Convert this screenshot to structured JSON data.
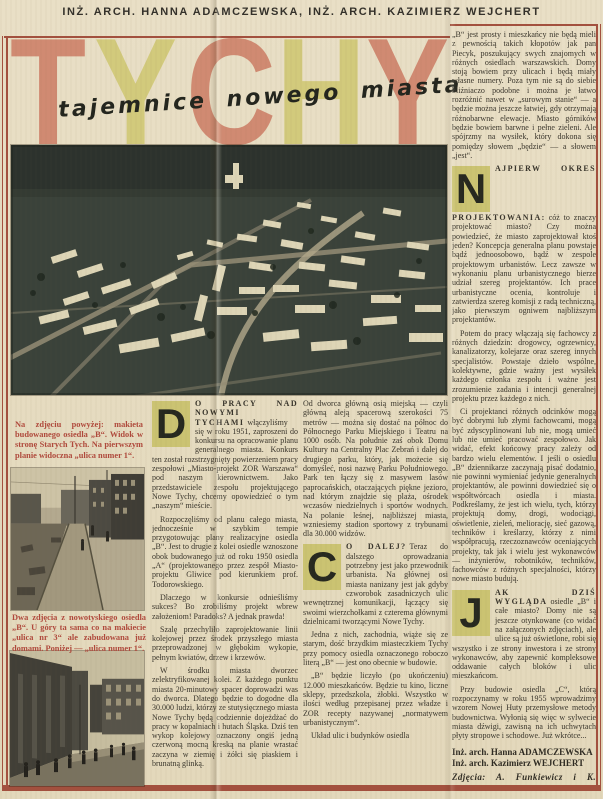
{
  "header": "INŻ. ARCH. HANNA ADAMCZEWSKA, INŻ. ARCH. KAZIMIERZ WEJCHERT",
  "title": {
    "letters": [
      "T",
      "Y",
      "C",
      "H",
      "Y"
    ],
    "subtitle": "tajemnice nowego miasta"
  },
  "colors": {
    "paper": "#e7ddc2",
    "frame_red": "#a3503e",
    "caption_red": "#b0493c",
    "title_salmon": "#d08a72",
    "title_olive": "#d2ca7c",
    "dropcap_bg": "#cbc372",
    "ink": "#37332a",
    "photo_dark": "#3a423a"
  },
  "captions": {
    "model": "Na zdjęciu powyżej: makieta budowanego osiedla „B“. Widok w stronę Starych Tych. Na pierwszym planie widoczna „ulica numer 1“.",
    "streets": "Dwa zdjęcia z nowotyskiego osiedla „B“. U góry ta sama co na makiecie „ulica nr 3“ ale zabudowana już domami. Poniżej — „ulica numer 1“."
  },
  "col1": {
    "drop1": "D",
    "lead1": "O PRACY NAD NOWYMI TYCHAMI",
    "p1": "włączyliśmy się w roku 1951, zaproszeni do konkursu na opracowanie planu generalnego miasta. Konkurs ten został rozstrzygnięty powierzeniem pracy zespołowi „Miasto-projekt ZOR Warszawa“ pod naszym kierownictwem. Jako przedstawiciele zespołu projektującego Nowe Tychy, chcemy opowiedzieć o tym „naszym“ mieście.",
    "p2": "Rozpoczęliśmy od planu całego miasta, jednocześnie w szybkim tempie przygotowując plany realizacyjne osiedla „B“. Jest to drugie z kolei osiedle wznoszone obok budowanego już od roku 1950 osiedla „A“ (projektowanego przez zespół Miasto-projektu Gliwice pod kierunkiem prof. Todorowskiego.",
    "p3": "Dlaczego w konkursie odnieśliśmy sukces? Bo zrobiliśmy projekt wbrew założeniom! Paradoks? A jednak prawda!",
    "p4": "Szalę przechyliło zaprojektowanie linii kolejowej przez środek przyszłego miasta przeprowadzonej w głębokim wykopie, pełnym kwiatów, drzew i krzewów.",
    "p5": "W środku miasta dworzec zelektryfikowanej kolei. Z każdego punktu miasta 20-minutowy spacer doprowadzi was do dworca. Dlatego będzie to dogodne dla 30.000 ludzi, którzy ze stutysięcznego miasta Nowe Tychy będą codziennie dojeżdżać do pracy w kopalniach i hutach Śląska. Dziś ten wykop kolejowy oznaczony ongiś jedną czerwoną mocną kreską na planie wrastać zaczyna w ziemię i żółci się piaskiem i brunatną glinką."
  },
  "col2": {
    "p1": "Od dworca główną osią miejską — czyli główną aleją spacerową szerokości 75 metrów — można się dostać na północ do Północnego Parku Miejskiego i Teatru na 1000 osób. Na południe zaś obok Domu Kultury na Centralny Plac Zebrań i dalej do drugiego parku, który, jak możecie się domyśleć, nosi nazwę Parku Południowego. Park ten łączy się z masywem lasów paprocańskich, otaczających piękne jezioro, nad którym znajdzie się plaża, ośrodek wczasów niedzielnych i sportów wodnych. Na polanie leśnej, najbliższej miasta, wzniesiemy stadion sportowy z trybunami dla 30.000 widzów.",
    "drop2": "C",
    "lead2": "O DALEJ?",
    "p2": "Teraz do dalszego oprowadzania potrzebny jest jako przewodnik urbanista. Na głównej osi miasta nanizany jest jak gdyby czworobok zasadniczych ulic wewnętrznej komunikacji, łączący się swoimi wierzchołkami z czterema głównymi dzielnicami tworzącymi Nowe Tychy.",
    "p3": "Jedna z nich, zachodnia, wiąże się ze starym, dość brzydkim miasteczkiem Tychy przy pomocy osiedla oznaczonego roboczo literą „B“ — jest ono obecnie w budowie.",
    "p4": "„B“ będzie liczyło (po ukończeniu) 12.000 mieszkańców. Będzie tu kino, liczne sklepy, przedszkola, żłobki. Wszystko w ilości według przepisanej przez władze i ZOR recepty nazywanej „normatywem urbanistycznym“.",
    "p5": "Układ ulic i budynków osiedla"
  },
  "colR": {
    "p1": "„B“ jest prosty i mieszkańcy nie będą mieli z pewnością takich kłopotów jak pan Piecyk, poszukujący swych znajomych w różnych osiedlach warszawskich. Domy stoją bowiem przy ulicach i będą miały własne numery. Poza tym nie są do siebie bliźniaczo podobne i można je łatwo rozróżnić nawet w „surowym stanie“ — a będzie można jeszcze łatwiej, gdy otrzymają różnobarwne elewacje. Miasto górników będzie bowiem barwne i pełne zieleni. Ale spójrzmy na wysiłek, który dokona się pomiędzy słowem „będzie“ — a słowem „jest“.",
    "drop2": "N",
    "lead2": "AJPIERW OKRES PROJEKTOWANIA:",
    "p2": "cóż to znaczy projektować miasto? Czy można powiedzieć, że miasto zaprojektował ktoś jeden? Koncepcja generalna planu powstaje bądź jednoosobowo, bądź w zespole projektowym urbanistów. Lecz zawsze w wykonaniu planu urbanistycznego bierze udział szereg projektantów. Ich prace urbanistyczne ocenia, kontroluje i zatwierdza szereg komisji z radą techniczną, jako pierwszym ogniwem najbliższym projektantów.",
    "p3": "Potem do pracy włączają się fachowcy z różnych dziedzin: drogowcy, ogrzewnicy, kanalizatorzy, kolejarze oraz szereg innych specjalistów. Powstaje dzieło wspólne, kolektywne, gdzie ważny jest wysiłek każdego członka zespołu i ważne jest zrozumienie zadania i intencji generalnej projektu przez każdego z nich.",
    "p4": "Ci projektanci różnych odcinków mogą być dobrymi lub złymi fachowcami, mogą być zdyscyplinowani lub nie, mogą umieć lub nie umieć pracować zespołowo. Jak widać, efekt końcowy pracy zależy od bardzo wielu elementów. I jeśli o osiedlu „B“ dziennikarze zaczynają pisać dodatnio, nie powinni wymieniać jedynie generalnych projektantów, ale powinni dowiedzieć się o współtwórcach osiedla i miasta. Podkreślamy, że jest ich wielu, tych, którzy projektują domy, drogi, wodociągi, oświetlenie, zieleń, meliorację, sieć gazową, techników i kreślarzy, którzy z nimi współpracują, rzeczoznawców oceniających projekty, tak jak i wielu jest wykonawców — inżynierów, robotników, techników, fachowców z różnych specjalności, którzy nowe miasto budują.",
    "drop5": "J",
    "lead5": "AK DZIŚ WYGLĄDA",
    "p5": "osiedle „B“ i całe miasto? Domy nie są jeszcze otynkowane (co widać na załączonych zdjęciach), ale ulice są już oświetlone, robi się wszystko i ze strony inwestora i ze strony wykonawców, aby zapewnić kompleksowe oddawanie całych bloków i ulic mieszkańcom.",
    "p6": "Przy budowie osiedla „C“, którą rozpoczynamy w roku 1955 wprowadzimy wzorem Nowej Huty przemysłowe metody budownictwa. Wyłonią się więc w sylwecie miasta dźwigi, zawisną na ich uchwytach płyty stropowe i schodowe. Już wkrótce..."
  },
  "credits": {
    "author1": "Inż. arch. Hanna ADAMCZEWSKA",
    "author2": "Inż. arch. Kazimierz WEJCHERT",
    "photos": "Zdjęcia: A. Funkiewicz i K. Wejchert"
  }
}
